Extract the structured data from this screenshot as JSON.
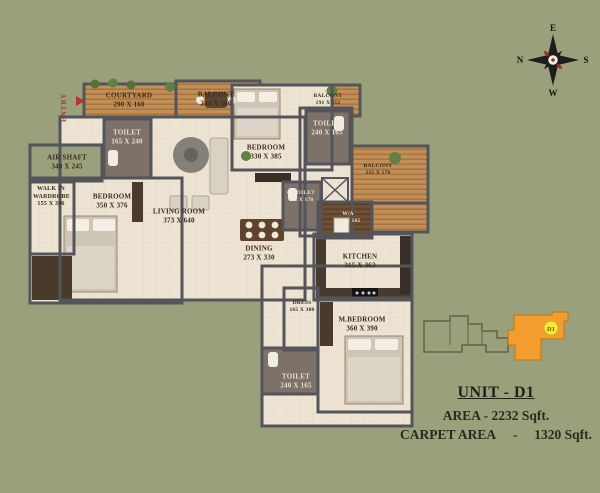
{
  "colors": {
    "background": "#9aa07b",
    "floor": "#ece3d2",
    "wall": "#54545b",
    "wood_deck": "#c28f58",
    "unit_highlight_orange": "#f49d2f",
    "unit_badge_yellow": "#f6e93a",
    "entry_red": "#b9342a"
  },
  "compass": {
    "top": "E",
    "right": "S",
    "bottom": "W",
    "left": "N"
  },
  "entry": {
    "label": "ENTRY"
  },
  "rooms": [
    {
      "name": "COURTYARD",
      "dims": "290 X 160"
    },
    {
      "name": "BALCONY",
      "dims": "244 X 160"
    },
    {
      "name": "BALCONY",
      "dims": "191 X 112"
    },
    {
      "name": "TOILET",
      "dims": "165 X 240"
    },
    {
      "name": "AIR SHAFT",
      "dims": "340 X 245"
    },
    {
      "name": "WALK IN WARDROBE",
      "dims": "155 X 306"
    },
    {
      "name": "BEDROOM",
      "dims": "350 X 376"
    },
    {
      "name": "LIVING ROOM",
      "dims": "373 X 640"
    },
    {
      "name": "BEDROOM",
      "dims": "330 X 385"
    },
    {
      "name": "TOILET",
      "dims": "240 X 165"
    },
    {
      "name": "BALCONY",
      "dims": "225 X 170"
    },
    {
      "name": "C.TOILET",
      "dims": "113 X 178"
    },
    {
      "name": "W/A",
      "dims": "238 X 165"
    },
    {
      "name": "DINING",
      "dims": "273 X 330"
    },
    {
      "name": "KITCHEN",
      "dims": "315 X 362"
    },
    {
      "name": "DRESS",
      "dims": "165 X 300"
    },
    {
      "name": "M.BEDROOM",
      "dims": "360 X 390"
    },
    {
      "name": "TOILET",
      "dims": "240 X 165"
    }
  ],
  "keyplan": {
    "unit_label": "D1"
  },
  "info": {
    "unit_title": "UNIT - D1",
    "area_line": "AREA - 2232 Sqft.",
    "carpet_label": "CARPET AREA",
    "carpet_dash": "-",
    "carpet_value": "1320 Sqft."
  }
}
